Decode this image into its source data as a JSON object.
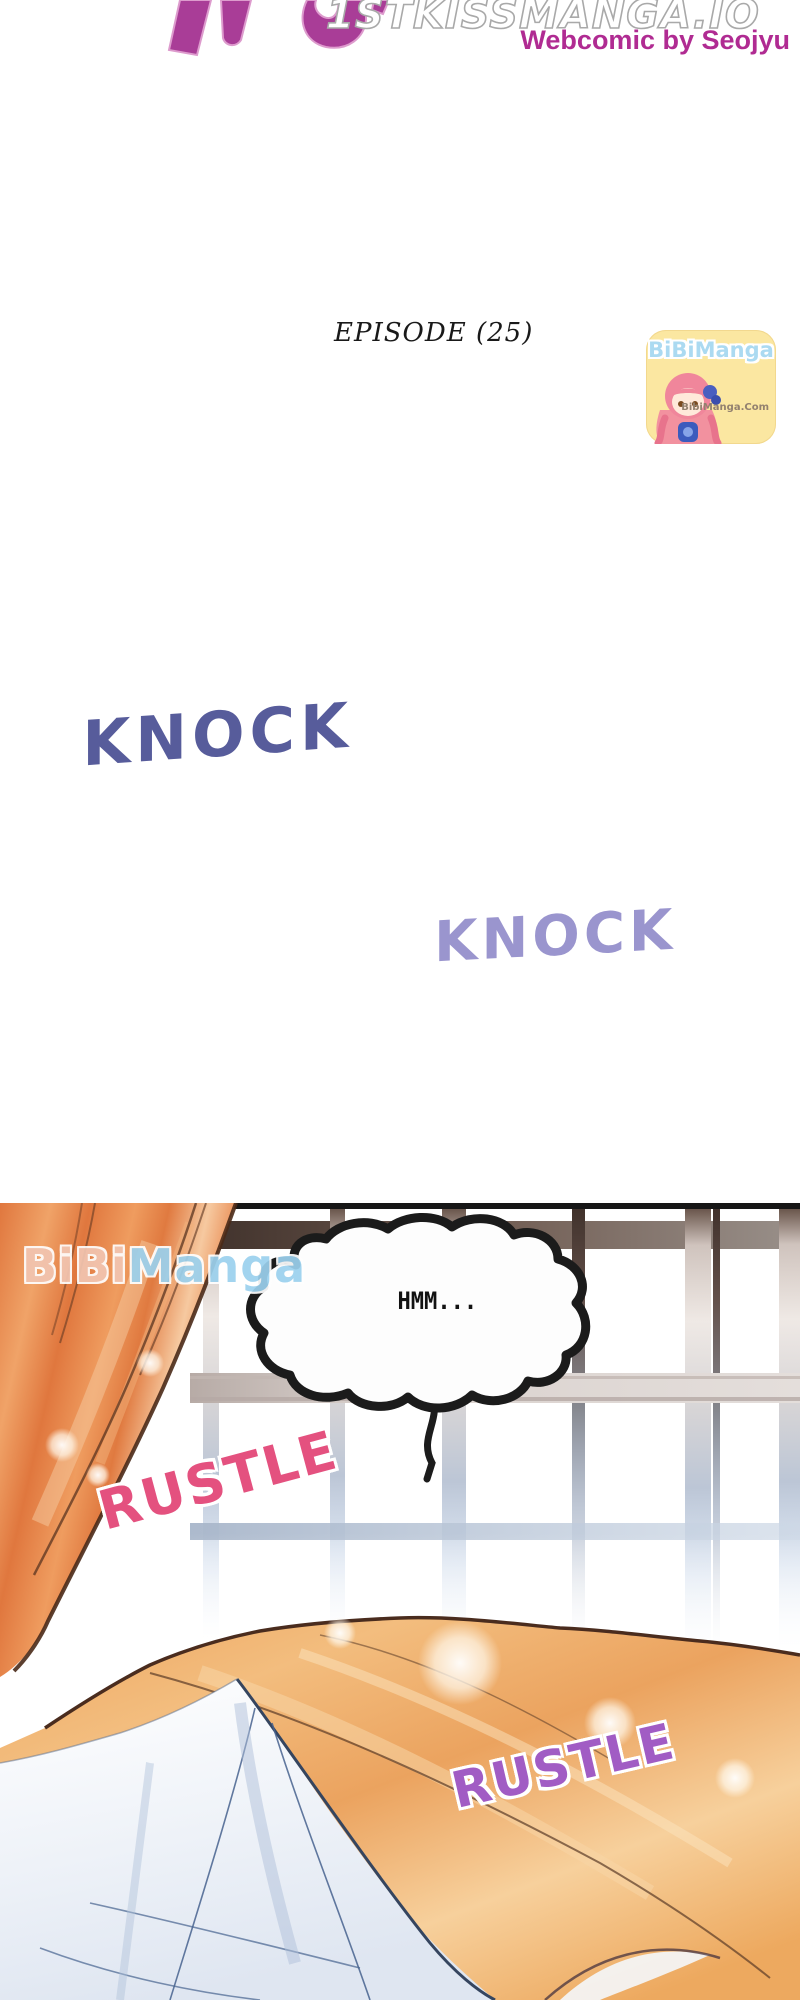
{
  "header": {
    "site_watermark": "1STKISSMANGA.IO",
    "credit": "Webcomic by Seojyu",
    "episode_label": "EPISODE (25)"
  },
  "badge": {
    "name": "BiBiManga",
    "url_label": "BibiManga.Com"
  },
  "panel_watermark": {
    "part1": "BiBi",
    "part2": "Manga"
  },
  "sfx": {
    "knock_1": "KNOCK",
    "knock_2": "KNOCK",
    "rustle_1": "RUSTLE",
    "rustle_2": "RUSTLE",
    "speech_bubble_text": "HMM..."
  },
  "colors": {
    "title_magenta": "#a93d97",
    "credit_magenta": "#b02b92",
    "knock_dark_blue": "#575c9b",
    "knock_light_purple": "#9a95ce",
    "rustle_pink": "#e4517f",
    "rustle_purple": "#a15cc4",
    "badge_yellow": "#fbe7a1",
    "badge_blue_text": "#abdaf1",
    "curtain_orange": "#e0773e",
    "blanket_orange": "#eda75f",
    "sheet_fold_blue": "#46628e",
    "window_frame_brown": "#41322c"
  }
}
